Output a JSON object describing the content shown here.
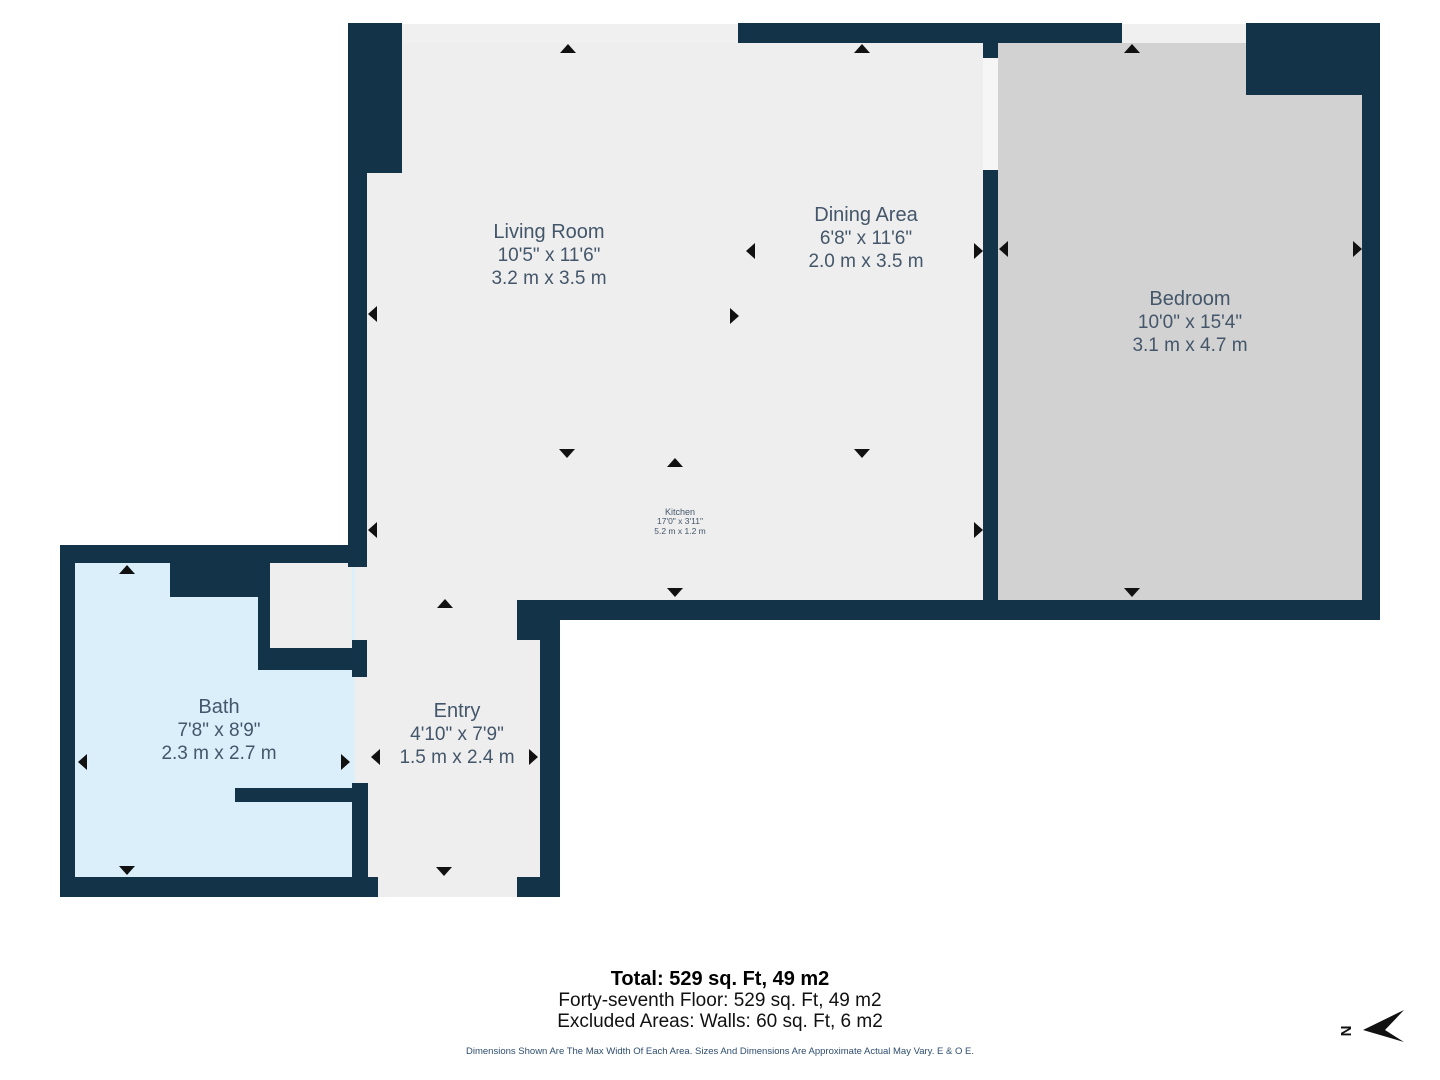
{
  "plan": {
    "rooms": {
      "living": {
        "name": "Living Room",
        "dims_ft": "10'5\" x 11'6\"",
        "dims_m": "3.2 m x 3.5 m"
      },
      "dining": {
        "name": "Dining Area",
        "dims_ft": "6'8\" x 11'6\"",
        "dims_m": "2.0 m x 3.5 m"
      },
      "bedroom": {
        "name": "Bedroom",
        "dims_ft": "10'0\" x 15'4\"",
        "dims_m": "3.1 m x 4.7 m"
      },
      "kitchen": {
        "name": "Kitchen",
        "dims_ft": "17'0\" x 3'11\"",
        "dims_m": "5.2 m x 1.2 m"
      },
      "bath": {
        "name": "Bath",
        "dims_ft": "7'8\" x 8'9\"",
        "dims_m": "2.3 m x 2.7 m"
      },
      "entry": {
        "name": "Entry",
        "dims_ft": "4'10\" x 7'9\"",
        "dims_m": "1.5 m x 2.4 m"
      }
    },
    "north_label": "N",
    "colors": {
      "wall": "#133349",
      "floor": "#eeeeee",
      "bedroom_floor": "#d2d2d2",
      "bath_floor": "#dbeffb",
      "arrow": "#111111",
      "label_text": "#44566a"
    }
  },
  "footer": {
    "total": "Total: 529 sq. Ft, 49 m2",
    "floor_line": "Forty-seventh Floor: 529 sq. Ft, 49 m2",
    "excluded_line": "Excluded Areas: Walls: 60 sq. Ft, 6 m2",
    "disclaimer": "Dimensions Shown Are The Max Width Of Each Area. Sizes And Dimensions Are Approximate Actual May Vary. E & O E."
  }
}
